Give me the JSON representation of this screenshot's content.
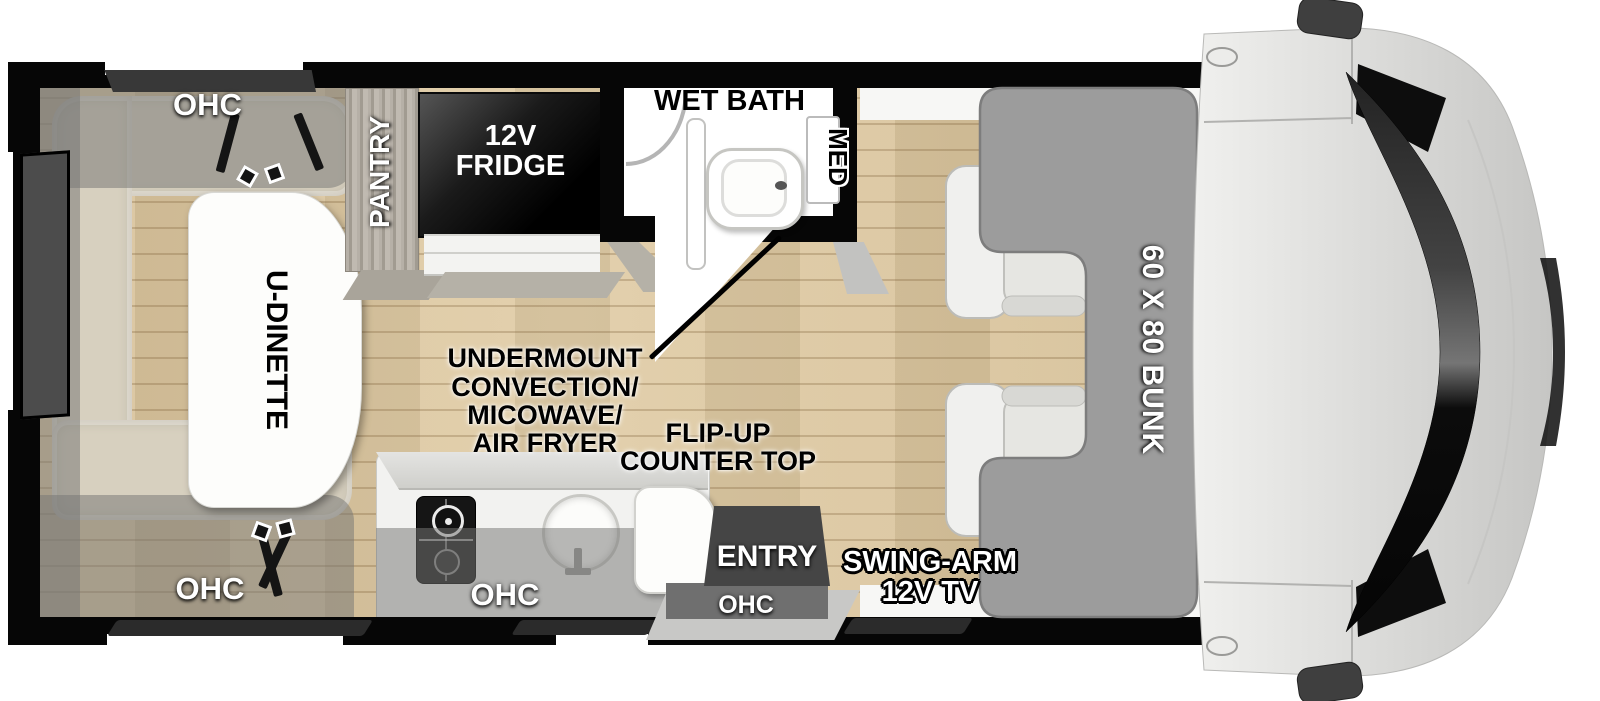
{
  "diagram": {
    "type": "rv-floorplan-top-view",
    "labels": {
      "ohc_dinette_top": "OHC",
      "ohc_dinette_bottom": "OHC",
      "ohc_kitchen": "OHC",
      "ohc_entry": "OHC",
      "pantry": "PANTRY",
      "fridge": [
        "12V",
        "FRIDGE"
      ],
      "wet_bath": "WET BATH",
      "med_cabinet": "MED",
      "dinette": "U-DINETTE",
      "undermount": [
        "UNDERMOUNT",
        "CONVECTION/",
        "MICOWAVE/",
        "AIR FRYER"
      ],
      "flip_up": [
        "FLIP-UP",
        "COUNTER TOP"
      ],
      "entry": "ENTRY",
      "tv": [
        "SWING-ARM",
        "12V TV"
      ],
      "bunk": "60 X 80 BUNK"
    },
    "colors": {
      "wall": "#060606",
      "floor_wood": "#d9c49e",
      "bench": "#d7d0bf",
      "bunk": "#9c9c9c",
      "cab_body": "#d9d9d7",
      "fridge": "#0a0a0a",
      "overhead_cabinet_overlay": "rgba(118,118,116,0.52)",
      "entry_block": "#454545"
    }
  }
}
